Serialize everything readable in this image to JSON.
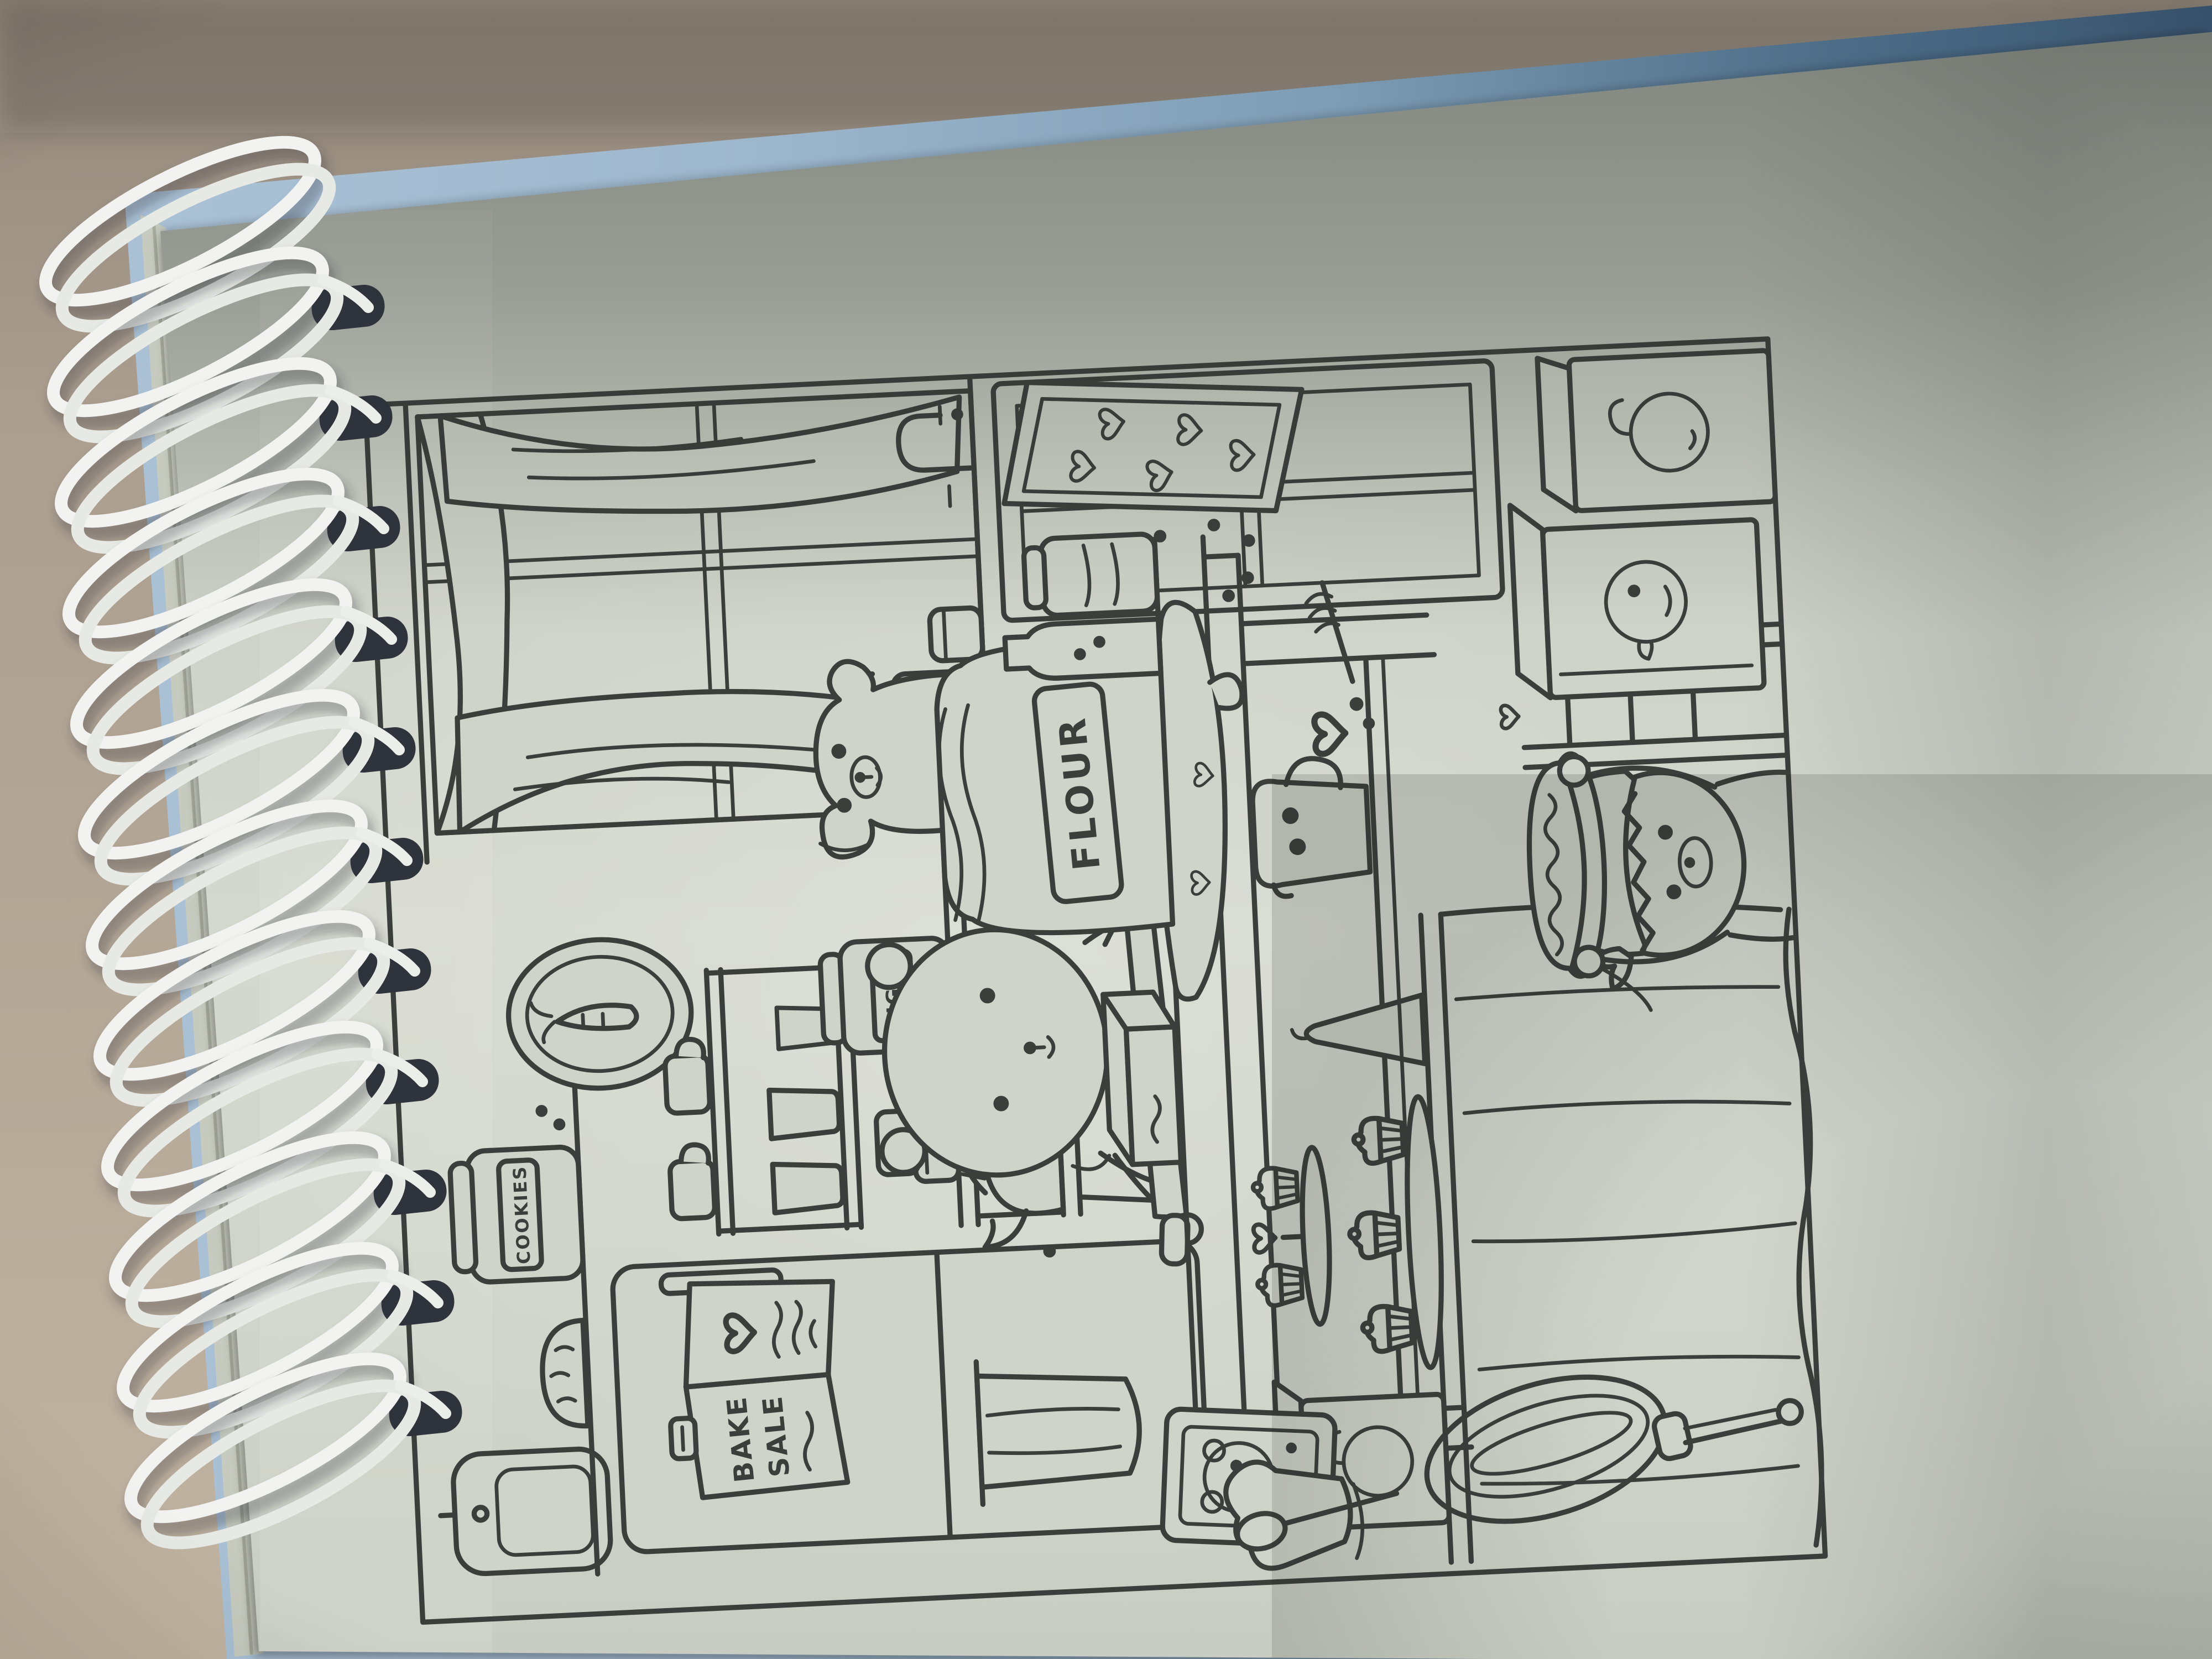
{
  "scene": {
    "type": "photograph of a spiral-bound coloring book lying on a table, artwork printed sideways (rotated 90 degrees)",
    "colors": {
      "table_surface": "#a89b8c",
      "table_surface_dark": "#8f8478",
      "cover_blue_light": "#a3bdd3",
      "cover_blue_dark": "#43607c",
      "page_light": "#d5d8cf",
      "page_shadow": "#9aa096",
      "line_art": "#3b3e3b",
      "coil_white": "#f2f3f1",
      "punch_hole": "#2f333c"
    },
    "notebook": {
      "binding_side": "left",
      "coil_count": 12,
      "page_tilt_deg": -5.5,
      "artwork_rotation_deg": -90
    },
    "illustration": {
      "style": "cute black line-art coloring page of a bakery kitchen (bake sale scene with bears)",
      "labels": {
        "flour": "FLOUR",
        "sugar": "SUGAR",
        "cookies": "COOKIES",
        "bake": "BAKE",
        "sale": "SALE"
      },
      "objects": [
        "cutting-board",
        "bread-loaf",
        "cookies-jar",
        "wall-shelf",
        "mug-shelf",
        "mugs",
        "cups",
        "carrot-wall-frame",
        "fridge",
        "bake-sale-sign",
        "kitchen-towel",
        "sugar-jar",
        "canister-stack",
        "teapot-with-heart",
        "stool",
        "butter-box",
        "bear-baker",
        "rolling-pin",
        "dough-with-heart-cutouts",
        "flour-sack",
        "milk-bottle",
        "preserve-jar",
        "window",
        "curtains",
        "faucet",
        "soap-pump",
        "counter-jar",
        "puppy-on-stool",
        "display-cabinet",
        "heart-cookie-tray",
        "creamer-pitcher",
        "heart-spill",
        "honey-dipper",
        "draped-table",
        "apple-gift-bag",
        "tiered-cupcake-stand",
        "cupcakes",
        "heart-topper",
        "piping-bag",
        "whisk",
        "bear-picture-card",
        "oven-mitt",
        "wooden-spoon",
        "pie-bear",
        "kerchief",
        "pie",
        "chair",
        "duck-paper-bag",
        "apple-paper-bag",
        "floor-heart"
      ]
    }
  }
}
